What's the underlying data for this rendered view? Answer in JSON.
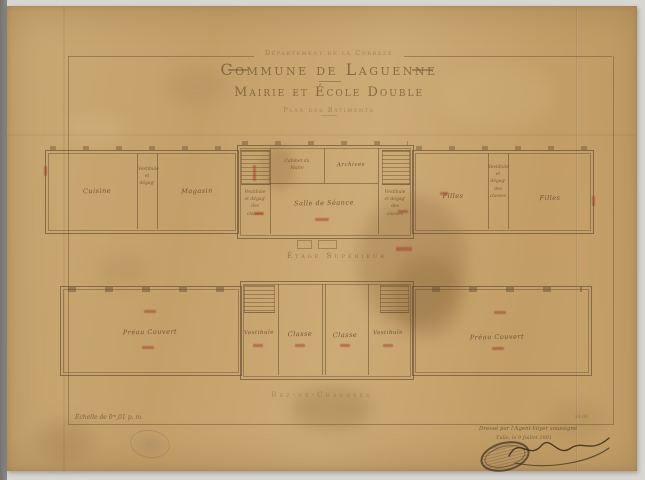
{
  "header": {
    "department": "Département de la Corrèze",
    "title": "Commune de Laguenne",
    "subtitle": "Mairie et École Double",
    "plan_note": "Plan des Bâtiments"
  },
  "upper_plan": {
    "caption": "Étage Supérieur",
    "rooms": {
      "cuisine": "Cuisine",
      "left_corridor": "Vestibule et dégagᵗ",
      "magasin": "Magasin",
      "stair_left": "Vestibule et dégagᵗ des classes",
      "cabinet": "Cabinet du Maire",
      "archives": "Archives",
      "hall": "Salle de Séance",
      "stair_right": "Vestibule et dégagᵗ des classes",
      "filles_1": "Filles",
      "right_corridor": "Vestibule et dégagᵗ des classes",
      "filles_2": "Filles"
    }
  },
  "lower_plan": {
    "caption": "Rez-de-Chaussée",
    "rooms": {
      "preau_left": "Préau Couvert",
      "vestibule_left": "Vestibule",
      "classe_1": "Classe",
      "classe_2": "Classe",
      "vestibule_right": "Vestibule",
      "preau_right": "Préau Couvert"
    }
  },
  "footer": {
    "scale": "Échelle de 0ᵐ,01 p. m.",
    "attribution": "Dressé par l'Agent-Voyer soussigné",
    "date_line": "Tulle, le 9 Juillet 1881",
    "corner_mark": "24,00"
  },
  "colors": {
    "paper": "#c8a56d",
    "ink": "#6b5134",
    "red_ink": "#a84a34",
    "scan_background": "#d8d6d1"
  }
}
